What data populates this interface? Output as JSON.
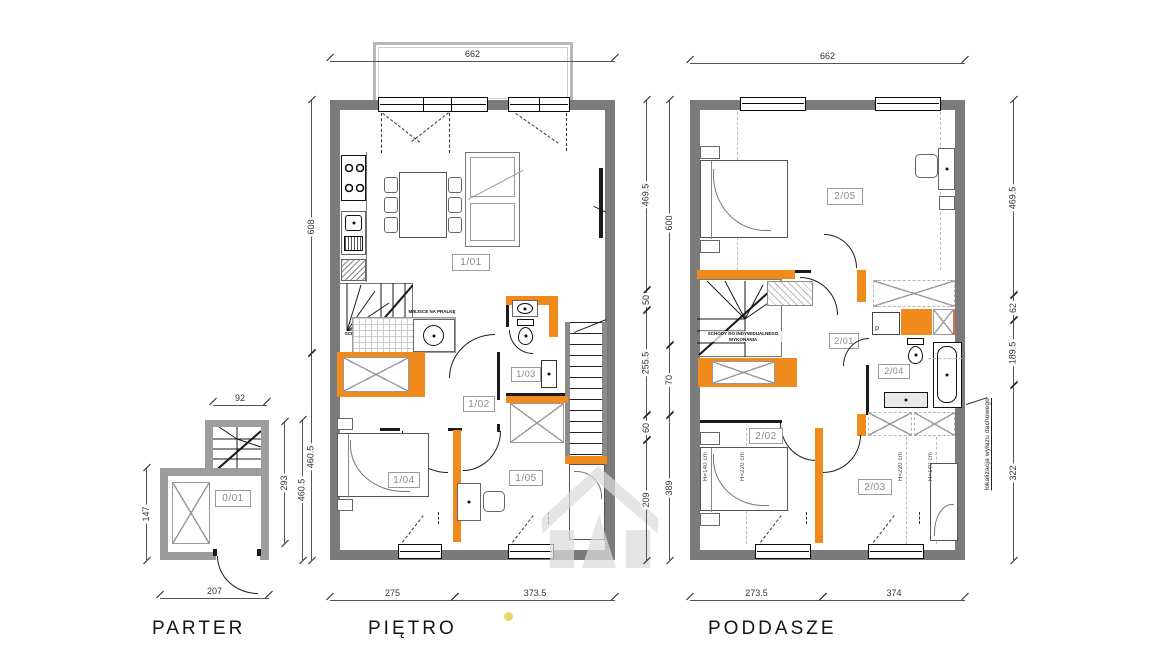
{
  "title_labels": {
    "parter": "PARTER",
    "pietro": "PIĘTRO",
    "poddasze": "PODDASZE"
  },
  "rooms": {
    "r001": "0/01",
    "r101": "1/01",
    "r102": "1/02",
    "r103": "1/03",
    "r104": "1/04",
    "r105": "1/05",
    "r201": "2/01",
    "r202": "2/02",
    "r203": "2/03",
    "r204": "2/04",
    "r205": "2/05"
  },
  "notes": {
    "stairs_custom": "SCHODY DO INDYWIDUALNEGO WYKONANIA",
    "laundry_spot": "MIEJSCE NA PRALKĘ",
    "roof_hatch": "lokalizacja wyłazu dachowego",
    "washer_letter": "P",
    "h140": "H=140 cm",
    "h220": "H=220 cm"
  },
  "dims": {
    "parter": {
      "top": "92",
      "left": "147",
      "right_inner": "293",
      "right_outer": "460.5",
      "bottom": "207"
    },
    "pietro": {
      "top": "662",
      "left": [
        "608",
        "460.5"
      ],
      "right_inner": [
        "469.5",
        "50",
        "255.5",
        "60",
        "209"
      ],
      "right_outer": [
        "600",
        "70",
        "389"
      ],
      "bottom": [
        "275",
        "373.5"
      ]
    },
    "poddasze": {
      "top": "662",
      "right": [
        "469.5",
        "62",
        "189.5",
        "322"
      ],
      "bottom": [
        "273.5",
        "374"
      ]
    }
  },
  "colors": {
    "accent_orange": "#F08A1D",
    "wall_dark": "#7B7B7B",
    "wall_light": "#9D9D9D",
    "dimension_text": "#333333",
    "room_label_gray": "#8A8A8A",
    "yellow_dot": "#EDD36B",
    "watermark_gray": "#DCDCDC"
  }
}
